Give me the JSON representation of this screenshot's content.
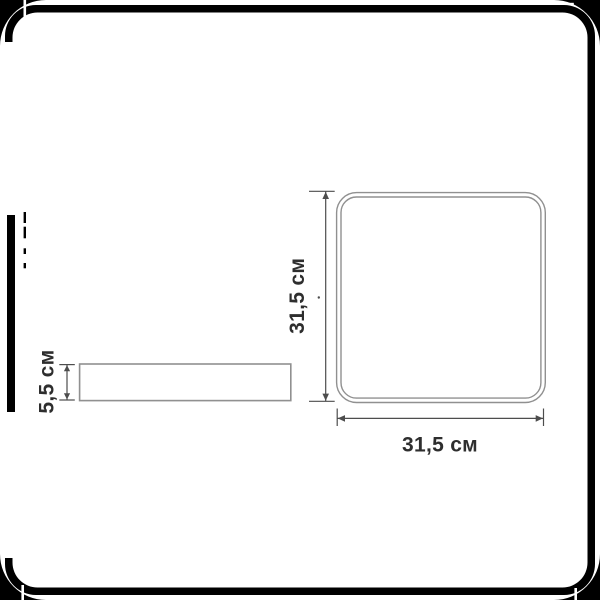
{
  "background": "#ffffff",
  "frame": {
    "color": "#000000"
  },
  "palette": {
    "product_outline": "#909090",
    "dimension_line": "#4d4d4d",
    "label_text": "#2e2e2e"
  },
  "top_view": {
    "height_label": "31,5 см",
    "width_label": "31,5 см",
    "height_value": "31,5",
    "width_value": "31,5",
    "unit": "см"
  },
  "side_view": {
    "height_label": "5,5 см",
    "height_value": "5,5",
    "unit": "см"
  }
}
